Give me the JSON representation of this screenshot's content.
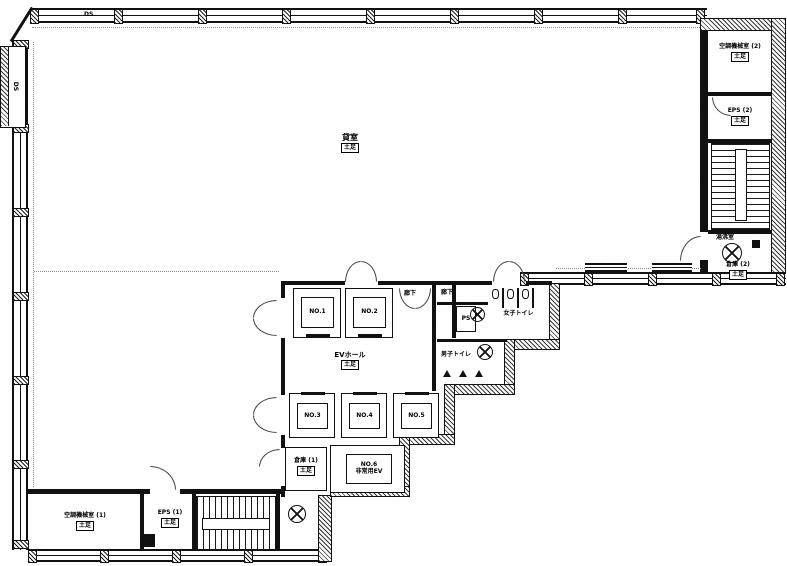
{
  "plan": {
    "paper_color": "#ffffff",
    "ink_color": "#111111",
    "labels": {
      "tenant_room": "貸室",
      "dosoku": "土足",
      "ev_hall": "EVホール",
      "corridor": "廊下",
      "ps": "PS",
      "ds": "DS",
      "women_toilet": "女子トイレ",
      "men_toilet": "男子トイレ",
      "machine_room_1": "空調機械室 (1)",
      "machine_room_2": "空調機械室 (2)",
      "eps_1": "EPS (1)",
      "eps_2": "EPS (2)",
      "storage_1": "倉庫 (1)",
      "storage_2": "倉庫 (2)",
      "pantry": "湯沸室",
      "emergency_ev_no": "NO.6",
      "emergency_ev_name": "非常用EV"
    },
    "elevators": [
      "NO.1",
      "NO.2",
      "NO.3",
      "NO.4",
      "NO.5"
    ]
  }
}
